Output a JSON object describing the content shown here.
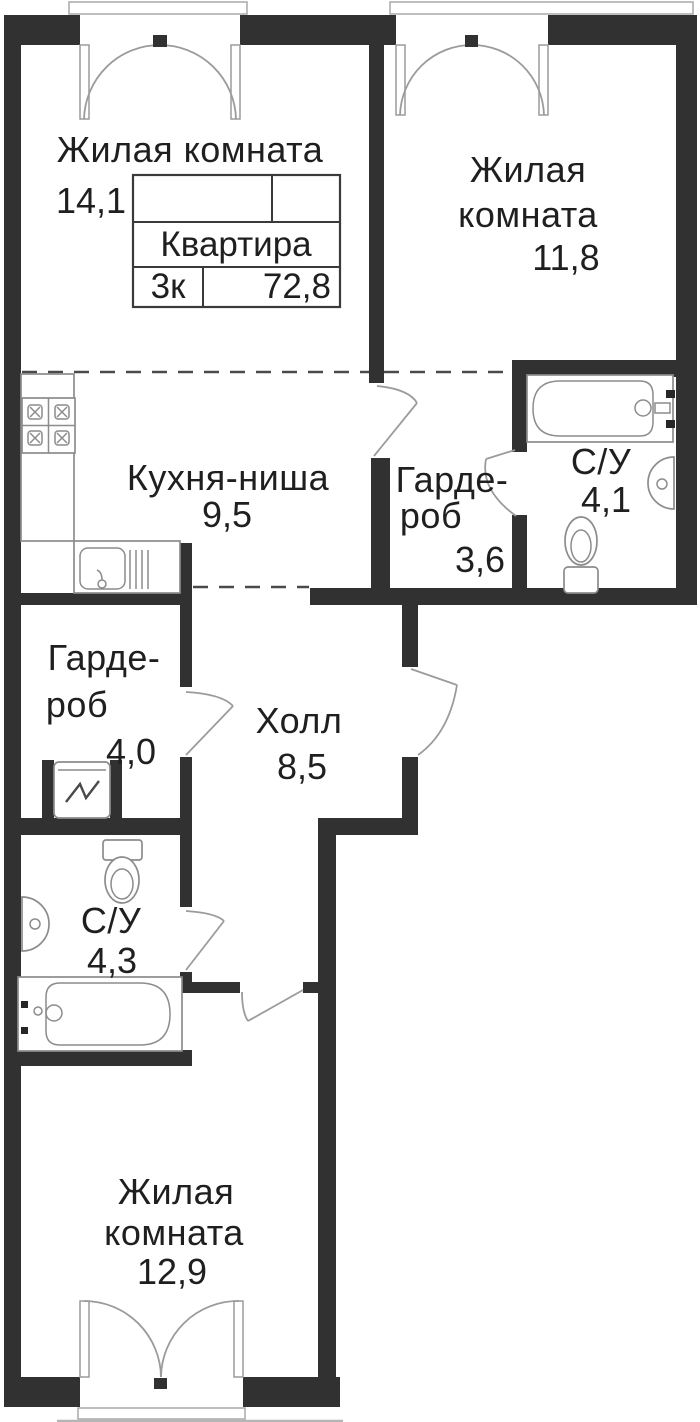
{
  "plan": {
    "type": "floor-plan",
    "info_box": {
      "title": "Квартира",
      "rooms_count": "3к",
      "total_area": "72,8"
    },
    "rooms": {
      "living_top_left": {
        "name": "Жилая комната",
        "area": "14,1"
      },
      "living_top_right": {
        "name_line1": "Жилая",
        "name_line2": "комната",
        "area": "11,8"
      },
      "kitchen_niche": {
        "name": "Кухня-ниша",
        "area": "9,5"
      },
      "wardrobe_top": {
        "name_line1": "Гарде-",
        "name_line2": "роб",
        "area": "3,6"
      },
      "bathroom_top": {
        "name": "С/У",
        "area": "4,1"
      },
      "wardrobe_bottom": {
        "name_line1": "Гарде-",
        "name_line2": "роб",
        "area": "4,0"
      },
      "hall": {
        "name": "Холл",
        "area": "8,5"
      },
      "bathroom_bottom": {
        "name": "С/У",
        "area": "4,3"
      },
      "living_bottom": {
        "name_line1": "Жилая",
        "name_line2": "комната",
        "area": "12,9"
      }
    },
    "fixtures": [
      "stove-icon",
      "kitchen-sink-icon",
      "bathtub-icon",
      "washbasin-icon",
      "toilet-icon",
      "washing-machine-icon"
    ],
    "colors": {
      "wall": "#313131",
      "fixture_line": "#8c8c8c",
      "door_line": "#9b9b9b",
      "dash_line": "#4a4a4a",
      "text": "#1f1f1f",
      "background": "#ffffff"
    }
  }
}
